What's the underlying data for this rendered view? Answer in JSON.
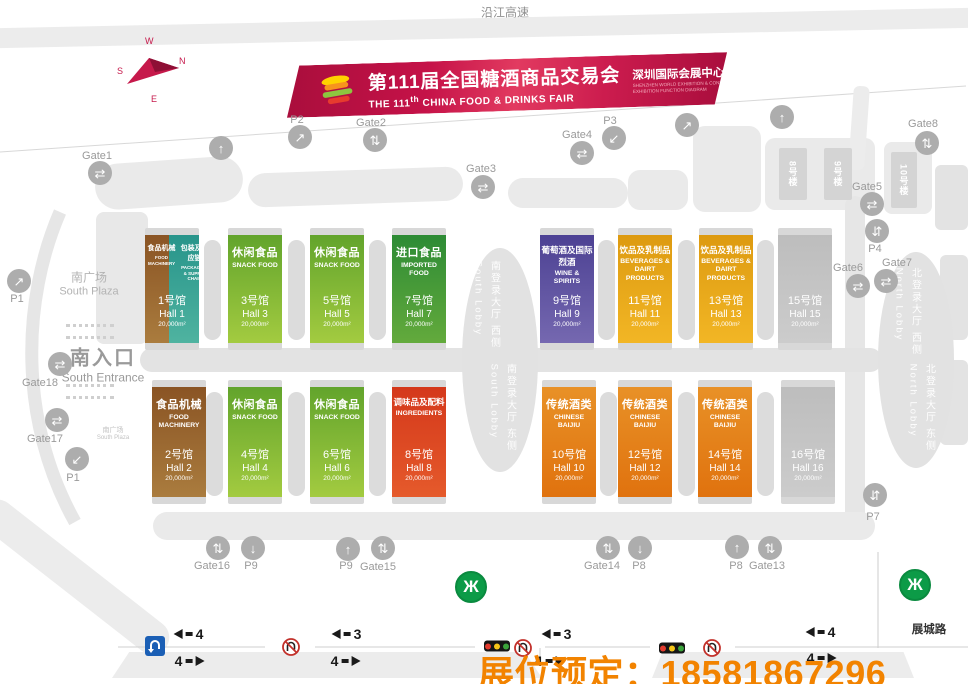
{
  "page": {
    "highway_label": "沿江高速",
    "road_label": "展城路",
    "booking_overlay": "展位预定：18581867296"
  },
  "banner": {
    "title_cn": "第111届全国糖酒商品交易会",
    "title_en_pre": "THE 111",
    "title_en_sup": "th",
    "title_en_post": " CHINA FOOD & DRINKS FAIR",
    "subtitle_cn": "深圳国际会展中心展区功能图",
    "subtitle_en1": "SHENZHEN WORLD EXHIBITION & CONVENTION CENTER",
    "subtitle_en2": "EXHIBITION FUNCTION DIAGRAM"
  },
  "compass": {
    "n": "N",
    "e": "E",
    "s": "S",
    "w": "W"
  },
  "icons": {
    "up": "↑",
    "down": "↓",
    "ne": "↗",
    "sw": "↙",
    "updown": "⇅",
    "leftright": "⇄",
    "swap": "⇵",
    "metro": "Ж"
  },
  "areas": {
    "south_plaza_cn": "南广场",
    "south_plaza_en": "South Plaza",
    "south_entrance_cn": "南入口",
    "south_entrance_en": "South Entrance",
    "south_plaza2_cn": "南广场",
    "south_plaza2_en": "South Plaza"
  },
  "lobbies": {
    "south_west_cn": "南登录大厅 西侧",
    "south_west_en": "South Lobby",
    "south_east_cn": "南登录大厅 东侧",
    "south_east_en": "South Lobby",
    "north_west_cn": "北登录大厅 西侧",
    "north_west_en": "North Lobby",
    "north_east_cn": "北登录大厅 东侧",
    "north_east_en": "North Lobby"
  },
  "buildings": [
    {
      "label": "8号楼"
    },
    {
      "label": "9号楼"
    },
    {
      "label": "10号楼"
    }
  ],
  "halls": [
    {
      "no": "1号馆",
      "hall": "Hall 1",
      "area": "20,000m²",
      "cat_left_cn": "食品机械",
      "cat_left_en": "FOOD MACHINERY",
      "cat_right_cn": "包装及供应链",
      "cat_right_en": "PACKAGING & SUPPLY CHAIN"
    },
    {
      "no": "3号馆",
      "hall": "Hall 3",
      "area": "20,000m²",
      "cat_cn": "休闲食品",
      "cat_en": "SNACK FOOD"
    },
    {
      "no": "5号馆",
      "hall": "Hall 5",
      "area": "20,000m²",
      "cat_cn": "休闲食品",
      "cat_en": "SNACK FOOD"
    },
    {
      "no": "7号馆",
      "hall": "Hall 7",
      "area": "20,000m²",
      "cat_cn": "进口食品",
      "cat_en": "IMPORTED FOOD"
    },
    {
      "no": "9号馆",
      "hall": "Hall 9",
      "area": "20,000m²",
      "cat_cn": "葡萄酒及国际烈酒",
      "cat_en": "WINE & SPIRITS"
    },
    {
      "no": "11号馆",
      "hall": "Hall 11",
      "area": "20,000m²",
      "cat_cn": "饮品及乳制品",
      "cat_en": "BEVERAGES & DAIRT PRODUCTS"
    },
    {
      "no": "13号馆",
      "hall": "Hall 13",
      "area": "20,000m²",
      "cat_cn": "饮品及乳制品",
      "cat_en": "BEVERAGES & DAIRT PRODUCTS"
    },
    {
      "no": "15号馆",
      "hall": "Hall 15",
      "area": "20,000m²"
    },
    {
      "no": "2号馆",
      "hall": "Hall 2",
      "area": "20,000m²",
      "cat_cn": "食品机械",
      "cat_en": "FOOD MACHINERY"
    },
    {
      "no": "4号馆",
      "hall": "Hall 4",
      "area": "20,000m²",
      "cat_cn": "休闲食品",
      "cat_en": "SNACK FOOD"
    },
    {
      "no": "6号馆",
      "hall": "Hall 6",
      "area": "20,000m²",
      "cat_cn": "休闲食品",
      "cat_en": "SNACK FOOD"
    },
    {
      "no": "8号馆",
      "hall": "Hall 8",
      "area": "20,000m²",
      "cat_cn": "调味品及配料",
      "cat_en": "INGREDIENTS"
    },
    {
      "no": "10号馆",
      "hall": "Hall 10",
      "area": "20,000m²",
      "cat_cn": "传统酒类",
      "cat_en": "CHINESE BAIJIU"
    },
    {
      "no": "12号馆",
      "hall": "Hall 12",
      "area": "20,000m²",
      "cat_cn": "传统酒类",
      "cat_en": "CHINESE BAIJIU"
    },
    {
      "no": "14号馆",
      "hall": "Hall 14",
      "area": "20,000m²",
      "cat_cn": "传统酒类",
      "cat_en": "CHINESE BAIJIU"
    },
    {
      "no": "16号馆",
      "hall": "Hall 16",
      "area": "20,000m²"
    }
  ],
  "markers": [
    {
      "label": "Gate1"
    },
    {
      "label": "P2"
    },
    {
      "label": "Gate2"
    },
    {
      "label": "Gate3"
    },
    {
      "label": "Gate4"
    },
    {
      "label": "P3"
    },
    {
      "label": "Gate8"
    },
    {
      "label": "P1"
    },
    {
      "label": "Gate18"
    },
    {
      "label": "Gate17"
    },
    {
      "label": "P1"
    },
    {
      "label": "Gate5"
    },
    {
      "label": "P4"
    },
    {
      "label": "Gate6"
    },
    {
      "label": "Gate7"
    },
    {
      "label": "Gate16"
    },
    {
      "label": "P9"
    },
    {
      "label": "P9"
    },
    {
      "label": "Gate15"
    },
    {
      "label": "Gate14"
    },
    {
      "label": "P8"
    },
    {
      "label": "P8"
    },
    {
      "label": "Gate13"
    },
    {
      "label": "P7"
    }
  ],
  "traffic": {
    "sections": [
      {
        "left": "4",
        "right": "4"
      },
      {
        "left": "3",
        "right": "4"
      },
      {
        "left": "3",
        "right": "4"
      },
      {
        "left": "4",
        "right": "4"
      }
    ]
  }
}
